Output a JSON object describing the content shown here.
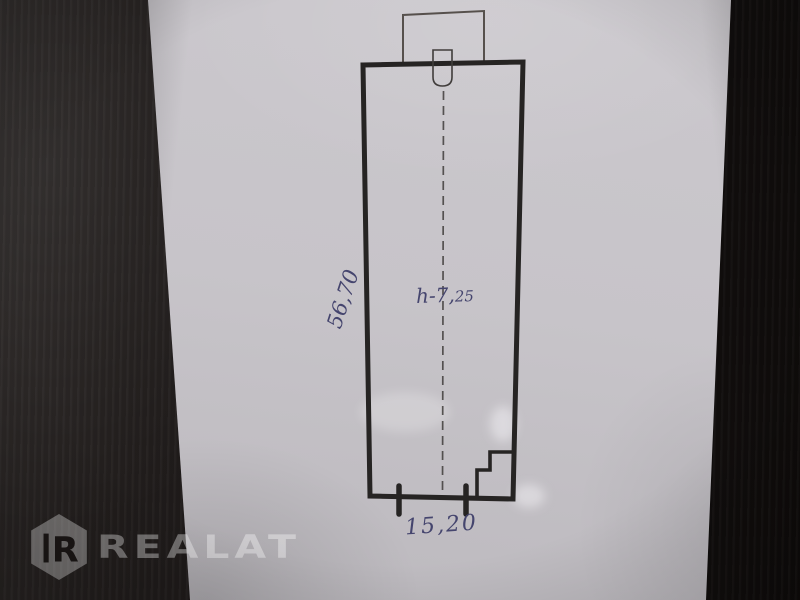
{
  "labels": {
    "side_dimension": "56,70",
    "height_note_prefix": "h-7,",
    "height_note_sub": "25",
    "bottom_dimension": "15,20"
  },
  "watermark": {
    "brand": "REALAT",
    "logo_letter": "R"
  },
  "colors": {
    "ink_blue": "#45456e",
    "marker_black": "#262423",
    "thin_line": "#56504c",
    "dash_line": "#403d3b",
    "paper_base": "#c7c4c9",
    "wood_dark": "#171413",
    "watermark_overlay": "rgba(255,255,255,0.36)",
    "logo_letter_dark": "#1a1615"
  }
}
